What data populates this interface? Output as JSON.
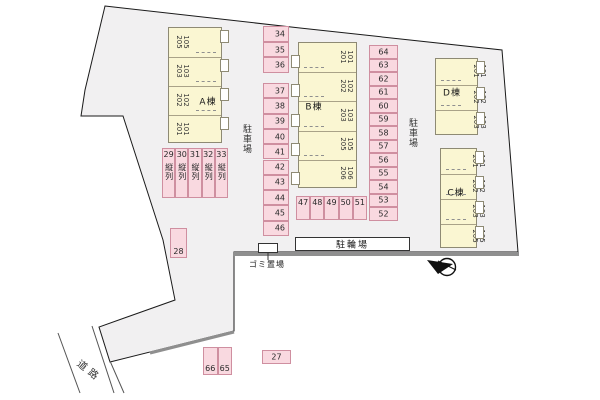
{
  "site": {
    "ground_color": "#f1f0f1",
    "building_fill": "#faf6d2",
    "stall_fill": "#f9d9e0",
    "stall_border": "#cf8fa0",
    "labels": {
      "parking_lot": "駐車場",
      "bicycle_parking": "駐輪場",
      "garbage_area": "ゴミ置場",
      "road": "道路",
      "tandem": "縦列"
    }
  },
  "buildings": [
    {
      "id": "A",
      "name": "A棟",
      "units": [
        {
          "upper": "205",
          "lower": "105"
        },
        {
          "upper": "203",
          "lower": "103"
        },
        {
          "upper": "202",
          "lower": "102"
        },
        {
          "upper": "201",
          "lower": "101"
        }
      ]
    },
    {
      "id": "B",
      "name": "B棟",
      "units": [
        {
          "upper": "201",
          "lower": "101"
        },
        {
          "upper": "202",
          "lower": "102"
        },
        {
          "upper": "203",
          "lower": "103"
        },
        {
          "upper": "205",
          "lower": "105"
        },
        {
          "upper": "206",
          "lower": "106"
        }
      ]
    },
    {
      "id": "D",
      "name": "D棟",
      "units": [
        {
          "upper": "201",
          "lower": "101"
        },
        {
          "upper": "202",
          "lower": "102"
        },
        {
          "upper": "203",
          "lower": "103"
        }
      ]
    },
    {
      "id": "C",
      "name": "C棟",
      "units": [
        {
          "upper": "201",
          "lower": "101"
        },
        {
          "upper": "202",
          "lower": "102"
        },
        {
          "upper": "203",
          "lower": "103"
        },
        {
          "upper": "205",
          "lower": "105"
        }
      ]
    }
  ],
  "parking": {
    "groups": [
      {
        "id": "col-34-36",
        "stalls": [
          "34",
          "35",
          "36"
        ]
      },
      {
        "id": "col-37-46",
        "stalls": [
          "37",
          "38",
          "39",
          "40",
          "41",
          "42",
          "43",
          "44",
          "45",
          "46"
        ]
      },
      {
        "id": "col-64-52",
        "stalls": [
          "64",
          "63",
          "62",
          "61",
          "60",
          "59",
          "58",
          "57",
          "56",
          "55",
          "54",
          "53",
          "52"
        ]
      },
      {
        "id": "row-29-33",
        "stalls": [
          "29",
          "30",
          "31",
          "32",
          "33"
        ],
        "tandem": true
      },
      {
        "id": "row-47-51",
        "stalls": [
          "47",
          "48",
          "49",
          "50",
          "51"
        ]
      },
      {
        "id": "stall-28",
        "stalls": [
          "28"
        ]
      },
      {
        "id": "pair-66-65",
        "stalls": [
          "66",
          "65"
        ]
      },
      {
        "id": "stall-27",
        "stalls": [
          "27"
        ]
      }
    ]
  }
}
